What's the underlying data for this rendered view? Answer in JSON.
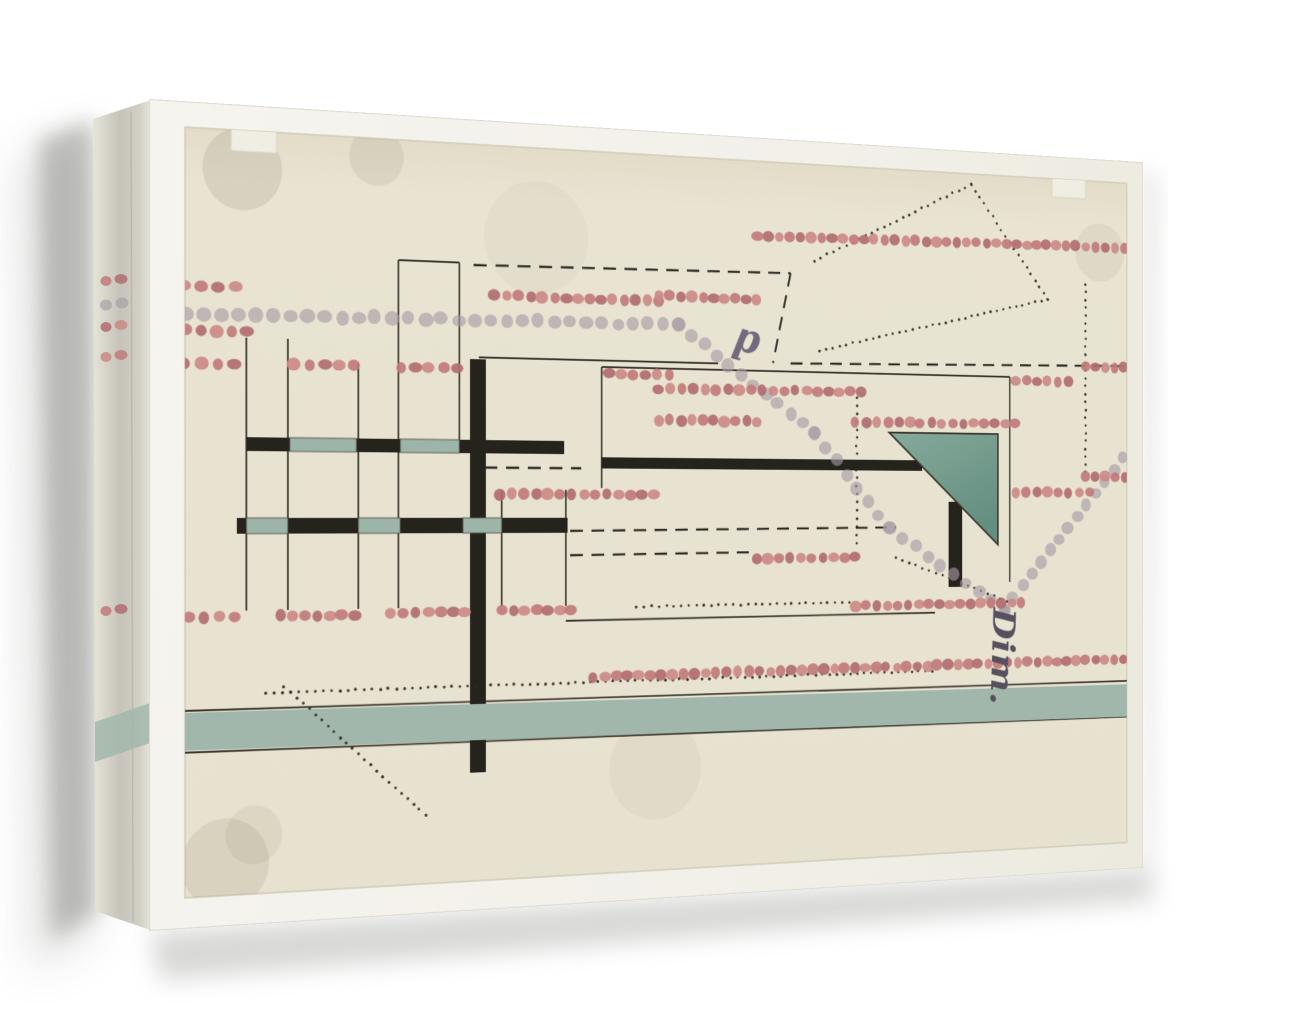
{
  "scene": {
    "description": "canvas print of abstract mechanical drawing on white wall",
    "wall_color": "#ffffff",
    "canvas_frame_color": "#f2f0e9",
    "paper_color": "#e9e4d2"
  },
  "artwork": {
    "inscriptions": {
      "dim": {
        "text": "Dim.",
        "x": 988,
        "y": 577,
        "rot": 92,
        "size": 42,
        "fill": "#56505f"
      },
      "d": {
        "text": "d",
        "x": 674,
        "y": 212,
        "rot": 193,
        "size": 46,
        "fill": "#746a7d"
      }
    },
    "colors": {
      "paper": "#e9e4d2",
      "paper_edge": "#cfc9b6",
      "red_dots": [
        "#c07b7a",
        "#b16d70",
        "#cb8a85"
      ],
      "gray_dot": "#a49aa3",
      "ink": "#2c2822",
      "line": "#3a362d",
      "bar": "#26221c",
      "teal_triangle_light": "#86aa9b",
      "teal_triangle_dark": "#648e80",
      "teal_band": "#a2b7ab",
      "teal_block": "#9db4a8"
    },
    "paper_rect": [
      36,
      25,
      1138,
      775
    ],
    "notches": [
      [
        84,
        14,
        48,
        32
      ],
      [
        1070,
        14,
        46,
        32
      ]
    ],
    "smudges": [
      [
        96,
        64,
        42,
        0.16
      ],
      [
        240,
        44,
        30,
        0.12
      ],
      [
        1136,
        108,
        34,
        0.1
      ],
      [
        78,
        768,
        46,
        0.14
      ],
      [
        108,
        740,
        30,
        0.1
      ],
      [
        560,
        690,
        55,
        0.06
      ],
      [
        420,
        120,
        60,
        0.05
      ]
    ],
    "lines": [
      [
        264,
        150,
        332,
        150
      ],
      [
        264,
        150,
        264,
        512
      ],
      [
        332,
        150,
        332,
        336
      ],
      [
        100,
        235,
        100,
        512
      ],
      [
        144,
        235,
        144,
        512
      ],
      [
        220,
        258,
        220,
        512
      ],
      [
        380,
        388,
        380,
        512
      ],
      [
        454,
        388,
        454,
        512
      ],
      [
        354,
        249,
        636,
        249
      ],
      [
        496,
        256,
        1012,
        256
      ],
      [
        496,
        256,
        496,
        386
      ],
      [
        1012,
        256,
        1012,
        492
      ],
      [
        454,
        528,
        912,
        526
      ],
      [
        36,
        612,
        1174,
        610
      ],
      [
        36,
        654,
        1174,
        652
      ]
    ],
    "dashed": [
      [
        348,
        152,
        726,
        147
      ],
      [
        726,
        147,
        704,
        247
      ],
      [
        726,
        247,
        1170,
        240
      ],
      [
        360,
        365,
        472,
        365
      ],
      [
        459,
        432,
        861,
        429
      ],
      [
        459,
        458,
        684,
        456
      ]
    ],
    "ink_dotted": [
      [
        120,
        596,
        908,
        592
      ],
      [
        140,
        590,
        294,
        728
      ],
      [
        810,
        283,
        810,
        446
      ],
      [
        756,
        132,
        960,
        37
      ],
      [
        960,
        37,
        1064,
        165
      ],
      [
        1064,
        165,
        762,
        232
      ],
      [
        1116,
        146,
        1116,
        365
      ],
      [
        861,
        463,
        1008,
        514
      ],
      [
        537,
        514,
        800,
        513
      ]
    ],
    "bars": [
      [
        344,
        251,
        18,
        435
      ],
      [
        100,
        336,
        352,
        14
      ],
      [
        90,
        418,
        366,
        16
      ],
      [
        496,
        353,
        399,
        12
      ],
      [
        930,
        400,
        18,
        97
      ]
    ],
    "teal_rects": [
      [
        146,
        336,
        72,
        14
      ],
      [
        266,
        336,
        66,
        14
      ],
      [
        100,
        418,
        44,
        16
      ],
      [
        220,
        418,
        46,
        16
      ],
      [
        336,
        418,
        44,
        16
      ]
    ],
    "band": [
      36,
      614,
      1138,
      38
    ],
    "triangle": [
      [
        852,
        322
      ],
      [
        996,
        322
      ],
      [
        996,
        449
      ]
    ],
    "red_rows": [
      [
        684,
        107,
        1170,
        101
      ],
      [
        372,
        183,
        564,
        183
      ],
      [
        564,
        177,
        684,
        177
      ],
      [
        36,
        229,
        100,
        229
      ],
      [
        36,
        262,
        88,
        262
      ],
      [
        150,
        261,
        216,
        261
      ],
      [
        266,
        261,
        330,
        261
      ],
      [
        504,
        263,
        577,
        263
      ],
      [
        1020,
        260,
        1092,
        260
      ],
      [
        1116,
        242,
        1170,
        242
      ],
      [
        564,
        278,
        816,
        277
      ],
      [
        564,
        312,
        684,
        312
      ],
      [
        808,
        311,
        1020,
        310
      ],
      [
        378,
        393,
        558,
        393
      ],
      [
        1020,
        389,
        1122,
        389
      ],
      [
        1116,
        370,
        1170,
        370
      ],
      [
        684,
        463,
        808,
        462
      ],
      [
        808,
        517,
        1028,
        516
      ],
      [
        40,
        518,
        88,
        518
      ],
      [
        136,
        518,
        216,
        518
      ],
      [
        256,
        517,
        338,
        517
      ],
      [
        380,
        516,
        460,
        516
      ],
      [
        486,
        589,
        1170,
        584
      ],
      [
        36,
        184,
        88,
        184
      ]
    ],
    "gray_chains": [
      [
        [
          36,
          212
        ],
        [
          588,
          208
        ]
      ],
      [
        [
          588,
          208
        ],
        [
          756,
          324
        ],
        [
          852,
          430
        ],
        [
          1004,
          524
        ]
      ],
      [
        [
          1004,
          524
        ],
        [
          1168,
          348
        ]
      ]
    ]
  },
  "side_face": {
    "quad": [
      [
        93,
        119
      ],
      [
        151,
        100
      ],
      [
        153,
        931
      ],
      [
        95,
        911
      ]
    ],
    "band_quad": [
      [
        95,
        722
      ],
      [
        153,
        702
      ],
      [
        153,
        742
      ],
      [
        95,
        762
      ]
    ],
    "red_mark_rows": [
      281,
      327,
      357,
      611
    ],
    "gray_mark_rows": [
      305
    ]
  }
}
